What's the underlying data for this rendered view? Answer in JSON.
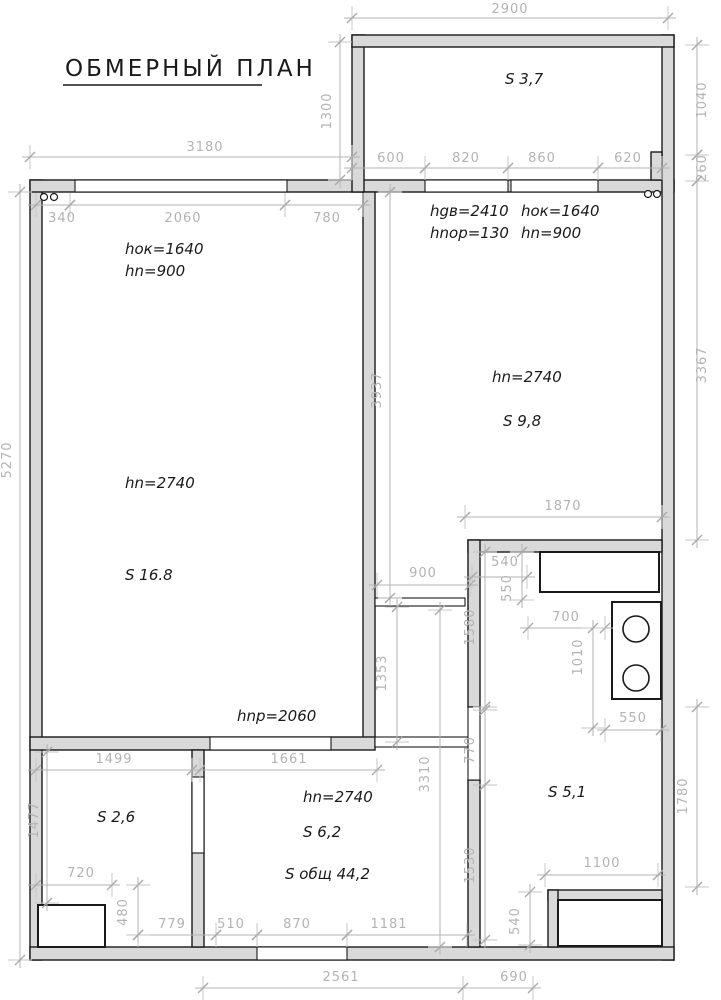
{
  "labels": {
    "title": "ОБМЕРНЫЙ ПЛАН",
    "balcony_area": "S 3,7",
    "bedroom_door_h": "hgв=2410",
    "bedroom_threshold_h": "hnор=130",
    "bedroom_window_h": "hок=1640",
    "bedroom_sill_h": "hn=900",
    "living_window_h": "hок=1640",
    "living_sill_h": "hn=900",
    "living_ceiling_h": "hn=2740",
    "living_area": "S 16.8",
    "bedroom_ceiling_h": "hn=2740",
    "bedroom_area": "S 9,8",
    "opening_h": "hnр=2060",
    "bath_area": "S 2,6",
    "hall_ceiling_h": "hn=2740",
    "hall_area": "S 6,2",
    "total_area": "S общ 44,2",
    "kitchen_area": "S 5,1"
  },
  "dims": {
    "w2900": "2900",
    "w3180": "3180",
    "w600": "600",
    "w820": "820",
    "w860": "860",
    "w620": "620",
    "w340": "340",
    "w2060": "2060",
    "w780": "780",
    "h1300": "1300",
    "h1040": "1040",
    "h260": "260",
    "h5270": "5270",
    "h3937": "3937",
    "h3367": "3367",
    "w1870": "1870",
    "w900": "900",
    "w540": "540",
    "h550": "550",
    "w700": "700",
    "h1010": "1010",
    "h1580": "1580",
    "w550": "550",
    "h770": "770",
    "h1353": "1353",
    "w1499": "1499",
    "w1661": "1661",
    "h1477": "1477",
    "w720": "720",
    "h3310": "3310",
    "h1530": "1530",
    "h1780": "1780",
    "w1100": "1100",
    "h540": "540",
    "h480": "480",
    "w779": "779",
    "w510": "510",
    "w870": "870",
    "w1181": "1181",
    "w2561": "2561",
    "w690": "690"
  },
  "colors": {
    "wall_fill": "#d9d9d9",
    "wall_edge": "#1a1a1a",
    "dim_color": "#b3b3b3",
    "background": "#ffffff"
  }
}
